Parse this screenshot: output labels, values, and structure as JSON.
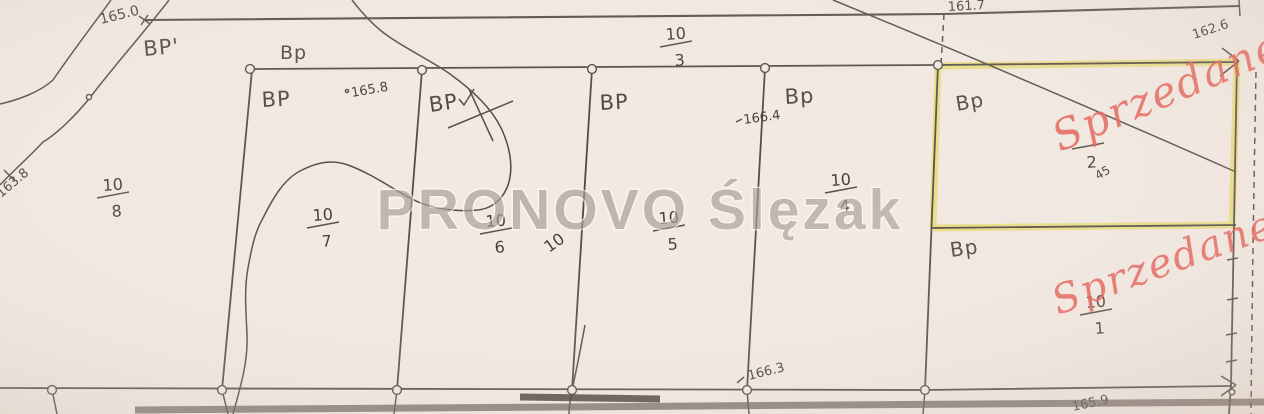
{
  "map_title": "Cadastral plot map (działki 10/1 - 10/8)",
  "watermark": {
    "text": "PRONOVO Ślęzak"
  },
  "colors": {
    "paper": "#f2e9e2",
    "ink": "#4d453e",
    "sold_highlight_yellow": "#e6da6d",
    "sold_text_red": "#e4564e",
    "watermark_gray": "#a39c95"
  },
  "labels": {
    "bp": [
      {
        "text": "BP'",
        "x": 144,
        "y": 56,
        "rot": -5,
        "size": 21
      },
      {
        "text": "Bp",
        "x": 280,
        "y": 59,
        "rot": 0,
        "size": 19
      },
      {
        "text": "BP",
        "x": 262,
        "y": 107,
        "rot": -3,
        "size": 21
      },
      {
        "text": "BP",
        "x": 430,
        "y": 112,
        "rot": -8,
        "size": 21
      },
      {
        "text": "BP",
        "x": 600,
        "y": 110,
        "rot": -3,
        "size": 21
      },
      {
        "text": "Bp",
        "x": 785,
        "y": 104,
        "rot": -3,
        "size": 21
      },
      {
        "text": "Bp",
        "x": 957,
        "y": 111,
        "rot": -10,
        "size": 20
      },
      {
        "text": "Bp",
        "x": 951,
        "y": 257,
        "rot": -8,
        "size": 20
      }
    ],
    "elevations": [
      {
        "text": "165.0",
        "x": 101,
        "y": 24,
        "rot": -14,
        "size": 14
      },
      {
        "text": "165.8",
        "x": 352,
        "y": 97,
        "rot": -10,
        "size": 13
      },
      {
        "text": "166.4",
        "x": 744,
        "y": 124,
        "rot": -8,
        "size": 13
      },
      {
        "text": "163.8",
        "x": 1,
        "y": 198,
        "rot": -40,
        "size": 13
      },
      {
        "text": "161.7",
        "x": 948,
        "y": 11,
        "rot": -3,
        "size": 13
      },
      {
        "text": "162.6",
        "x": 1194,
        "y": 39,
        "rot": -18,
        "size": 13
      },
      {
        "text": "166.3",
        "x": 749,
        "y": 380,
        "rot": -14,
        "size": 13
      },
      {
        "text": "165.9",
        "x": 1073,
        "y": 411,
        "rot": -12,
        "size": 13
      }
    ],
    "misc": [
      {
        "text": "10",
        "x": 549,
        "y": 253,
        "rot": -35,
        "size": 16
      }
    ],
    "sold": [
      {
        "text": "Sprzedane",
        "x": 1060,
        "y": 152,
        "rot": -23,
        "size": 42
      },
      {
        "text": "Sprzedane",
        "x": 1058,
        "y": 315,
        "rot": -20,
        "size": 40
      }
    ],
    "plots": [
      {
        "num": "10",
        "den": "8",
        "x": 103,
        "y": 191
      },
      {
        "num": "10",
        "den": "7",
        "x": 313,
        "y": 221
      },
      {
        "num": "10",
        "den": "6",
        "x": 486,
        "y": 227
      },
      {
        "num": "10",
        "den": "5",
        "x": 659,
        "y": 224
      },
      {
        "num": "10",
        "den": "4",
        "x": 831,
        "y": 186
      },
      {
        "num": "10",
        "den": "3",
        "x": 666,
        "y": 40
      },
      {
        "num": "10",
        "den": "1",
        "x": 1086,
        "y": 308
      },
      {
        "num": "",
        "den": "2",
        "extra": "45",
        "x": 1078,
        "y": 142
      }
    ]
  }
}
